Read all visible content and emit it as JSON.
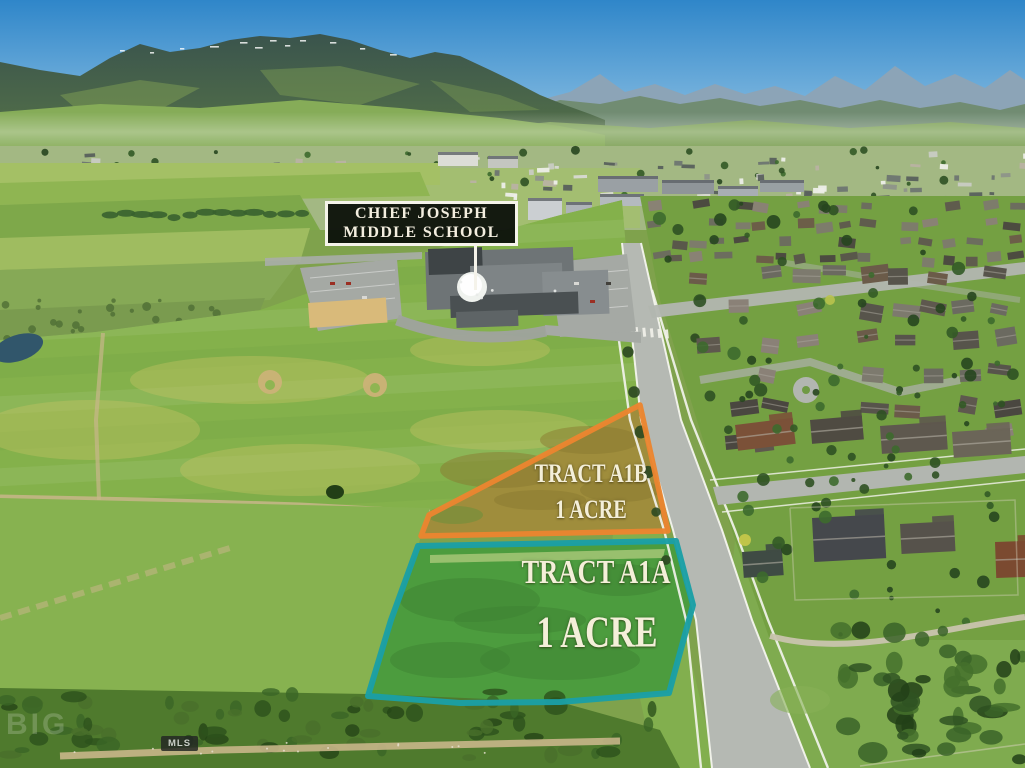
{
  "image": {
    "school_label": {
      "line1": "CHIEF JOSEPH",
      "line2": "MIDDLE SCHOOL"
    },
    "tracts": [
      {
        "name": "TRACT A1B",
        "area": "1 ACRE",
        "outline_color": "#EA8530",
        "field_color": "#9F8D3C"
      },
      {
        "name": "TRACT A1A",
        "area": "1 ACRE",
        "outline_color": "#1B9FA5",
        "field_color": "#4C9C3E"
      }
    ],
    "watermark_text": "BIG",
    "mls_badge": "MLS",
    "palette": {
      "sky_top": "#2F86C9",
      "sky_horizon": "#BBDDF0",
      "far_mountains": "#8CA4B7",
      "mountain_dark": "#3A544D",
      "mountain_green": "#587547",
      "foothills": "#86AC58",
      "valley": "#A3B883",
      "field_green": "#84B14B",
      "pasture": "#87B250",
      "road": "#B5B9B3",
      "sidewalk": "#F4F4EE",
      "lawn": "#74A042",
      "tree_dark": "#2F5124",
      "dirt": "#C8B68A",
      "scrub": "#4F7A2D",
      "parking": "#A5A9A4",
      "dome": "#EFF2EE"
    }
  }
}
